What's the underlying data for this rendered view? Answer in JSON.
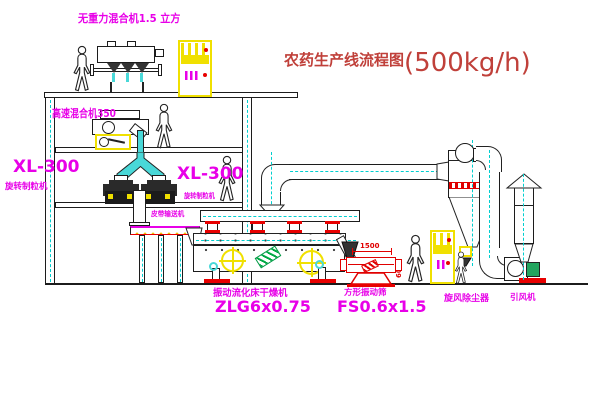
{
  "title": {
    "name": "农药生产线流程图",
    "capacity": "(500kg/h)"
  },
  "equipment": {
    "gravity_mixer": {
      "label": "无重力混合机1.5 立方"
    },
    "high_speed_mixer": {
      "label": "高速混合机350"
    },
    "granulator_left": {
      "model": "XL-300",
      "name": "旋转制粒机"
    },
    "granulator_right": {
      "model": "XL-300",
      "name": "旋转制粒机"
    },
    "belt_conveyor": {
      "name": "皮带输送机"
    },
    "dryer": {
      "name": "振动流化床干燥机",
      "model": "ZLG6x0.75"
    },
    "screen": {
      "name": "方形振动筛",
      "model": "FS0.6x1.5",
      "dim_length": "1500",
      "dim_width": "600"
    },
    "cyclone": {
      "name": "旋风除尘器"
    },
    "fan": {
      "name": "引风机"
    }
  },
  "colors": {
    "label_magenta": "#e800e8",
    "title_red": "#c0403a",
    "pipe_cyan": "#49d8d8",
    "accent_yellow": "#f0e000",
    "flange_red": "#e80000",
    "motor_green": "#23a55f",
    "line_black": "#1c1c1c"
  }
}
